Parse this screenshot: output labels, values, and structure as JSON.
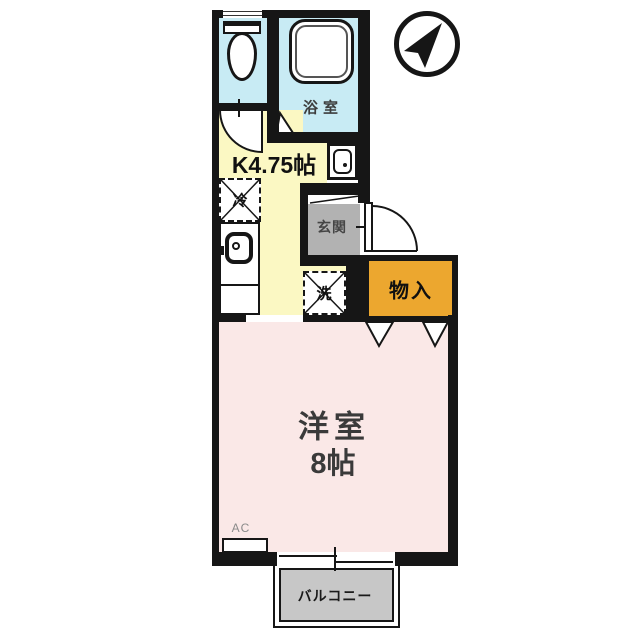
{
  "rooms": {
    "bathroom": {
      "label": "浴室"
    },
    "kitchen": {
      "label": "K4.75帖"
    },
    "entrance": {
      "label": "玄関"
    },
    "storage": {
      "label": "物入"
    },
    "main_room": {
      "name_label": "洋室",
      "size_label": "8帖"
    },
    "balcony": {
      "label": "バルコニー"
    }
  },
  "fixtures": {
    "refrigerator": {
      "label": "冷"
    },
    "washing_machine": {
      "label": "洗"
    },
    "air_conditioner": {
      "label": "AC"
    }
  },
  "colors": {
    "wall": "#161616",
    "line": "#161616",
    "wet_floor": "#c8ebf4",
    "kitchen_floor": "#fbf8c3",
    "main_floor": "#fae8e7",
    "entrance_floor": "#b2b2b2",
    "storage_fill": "#eca72f",
    "balcony_fill": "#c7c7c7",
    "background": "#ffffff"
  }
}
